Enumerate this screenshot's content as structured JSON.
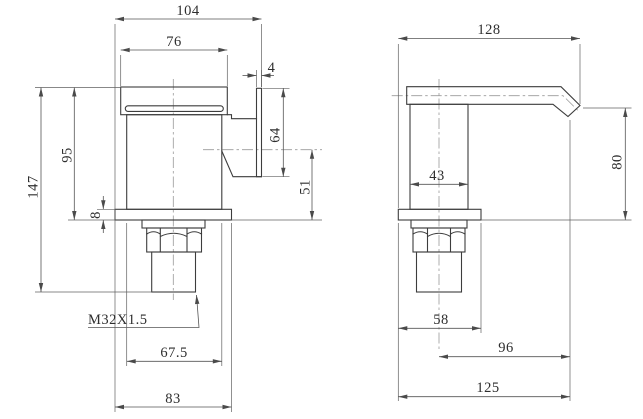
{
  "drawing": {
    "views": {
      "front": {
        "dims": {
          "overall_width": "104",
          "spout_top_width": "76",
          "handle_plate_thickness": "4",
          "handle_plate_height": "64",
          "deck_to_spout_top": "95",
          "overall_height": "147",
          "deck_plate_thickness": "8",
          "handle_axis_to_deck": "51",
          "thread_spec": "M32X1.5",
          "body_width": "67.5",
          "deck_plate_width": "83"
        }
      },
      "side": {
        "dims": {
          "overall_depth": "128",
          "body_depth": "43",
          "deck_to_outlet_height": "80",
          "deck_plate_depth": "58",
          "axis_to_spout_tip": "96",
          "base_to_spout_tip": "125"
        }
      }
    }
  }
}
